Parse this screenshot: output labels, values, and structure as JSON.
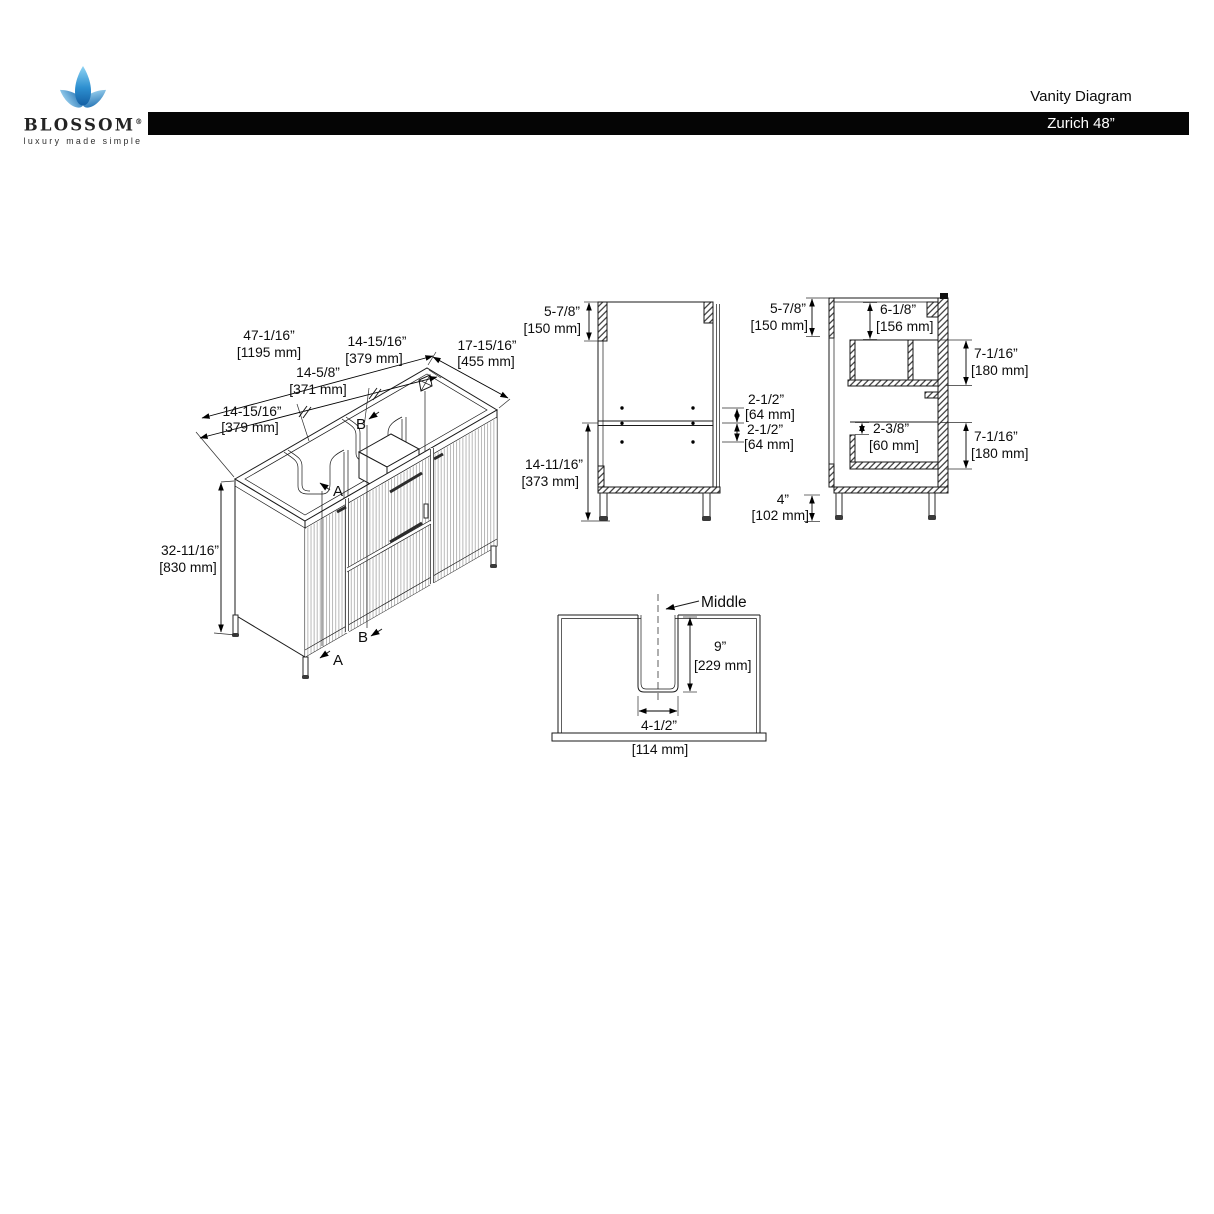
{
  "header": {
    "brand": "BLOSSOM",
    "registered": "®",
    "tagline": "luxury made simple",
    "doc_title": "Vanity Diagram",
    "model": "Zurich 48”"
  },
  "colors": {
    "header_bar": "#000000",
    "line": "#1a1a1a",
    "logo_blue_light": "#8fd4f4",
    "logo_blue_dark": "#145fa3"
  },
  "isometric_view": {
    "total_width_in": "47-1/16”",
    "total_width_mm": "[1195 mm]",
    "seg_left_in": "14-15/16”",
    "seg_left_mm": "[379 mm]",
    "seg_mid_in": "14-5/8”",
    "seg_mid_mm": "[371 mm]",
    "seg_right_in": "14-15/16”",
    "seg_right_mm": "[379 mm]",
    "depth_in": "17-15/16”",
    "depth_mm": "[455 mm]",
    "height_in": "32-11/16”",
    "height_mm": "[830 mm]",
    "label_a_top": "A",
    "label_a_bottom": "A",
    "label_b_top": "B",
    "label_b_bottom": "B"
  },
  "front_section_view": {
    "top_rail_in": "5-7/8”",
    "top_rail_mm": "[150 mm]",
    "gap_upper_in": "2-1/2”",
    "gap_upper_mm": "[64 mm]",
    "gap_lower_in": "2-1/2”",
    "gap_lower_mm": "[64 mm]",
    "below_shelf_in": "14-11/16”",
    "below_shelf_mm": "[373 mm]",
    "leg_in": "4”",
    "leg_mm": "[102 mm]"
  },
  "side_section_view": {
    "top_rail_in": "5-7/8”",
    "top_rail_mm": "[150 mm]",
    "top_inset_in": "6-1/8”",
    "top_inset_mm": "[156 mm]",
    "upper_drawer_in": "7-1/16”",
    "upper_drawer_mm": "[180 mm]",
    "drawer_inner_in": "2-3/8”",
    "drawer_inner_mm": "[60 mm]",
    "lower_drawer_in": "7-1/16”",
    "lower_drawer_mm": "[180 mm]"
  },
  "cutout_detail": {
    "middle_label": "Middle",
    "slot_depth_in": "9”",
    "slot_depth_mm": "[229 mm]",
    "slot_width_in": "4-1/2”",
    "slot_width_mm": "[114 mm]"
  }
}
